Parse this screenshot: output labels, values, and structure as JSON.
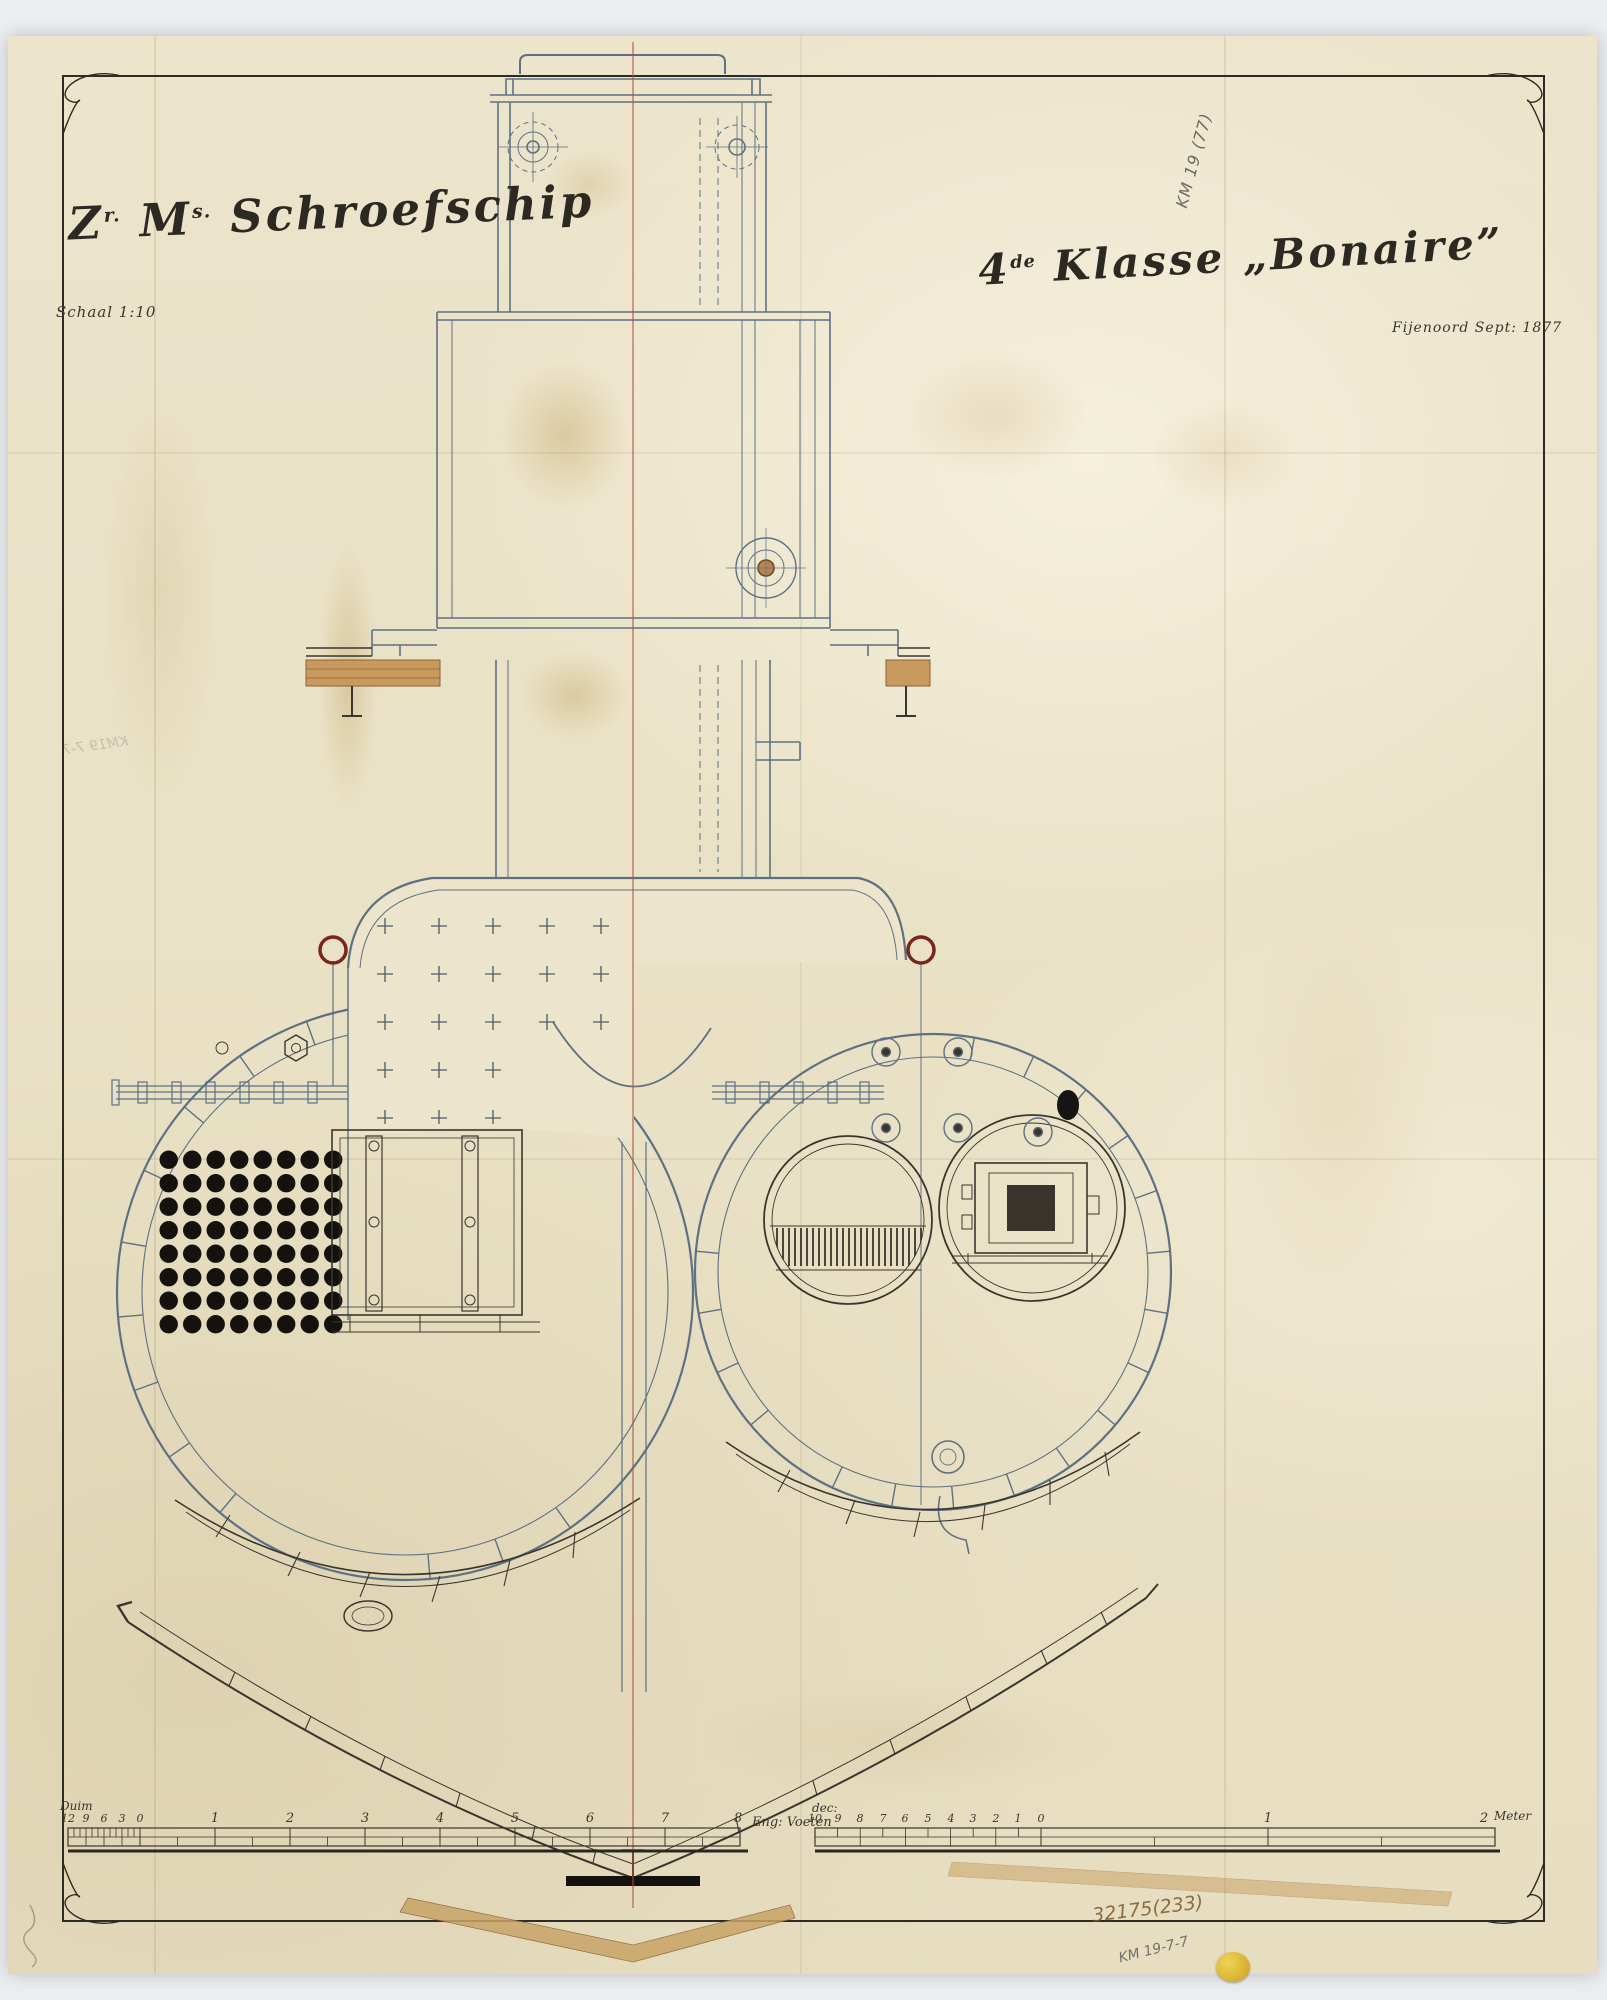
{
  "titles": {
    "left": {
      "z": "Z",
      "z_sup": "r.",
      "m": "M",
      "m_sup": "s.",
      "ship": "Schroefschip"
    },
    "right": {
      "num": "4",
      "num_sup": "de",
      "klasse": "Klasse",
      "name": "„Bonaire”"
    },
    "scale_note": "Schaal 1:10",
    "yard_date": "Fijenoord Sept: 1877"
  },
  "annotations": {
    "top_right": "KM 19 (77)",
    "left_mirror": "KM19 7-7",
    "bottom_number": "32175(233)",
    "bottom_mark": "KM 19-7-7"
  },
  "scales": {
    "english": {
      "unit_left": "Duim",
      "ticks": [
        "12",
        "9",
        "6",
        "3",
        "0",
        "1",
        "2",
        "3",
        "4",
        "5",
        "6",
        "7",
        "8"
      ],
      "unit_right": "Eng: Voeten"
    },
    "metric": {
      "unit_left": "dec:",
      "ticks": [
        "10",
        "9",
        "8",
        "7",
        "6",
        "5",
        "4",
        "3",
        "2",
        "1",
        "0",
        "1",
        "2"
      ],
      "unit_right": "Meter"
    }
  },
  "colors": {
    "paper": "#ece4cb",
    "ink": "#3a362f",
    "steel_blue": "#5d7183",
    "centerline_red": "#b05040",
    "dark_red_ring": "#7c241c",
    "deck_tan": "#c99a5e",
    "tube_black": "#15120e",
    "sticker_yellow": "#d7ac2c"
  }
}
